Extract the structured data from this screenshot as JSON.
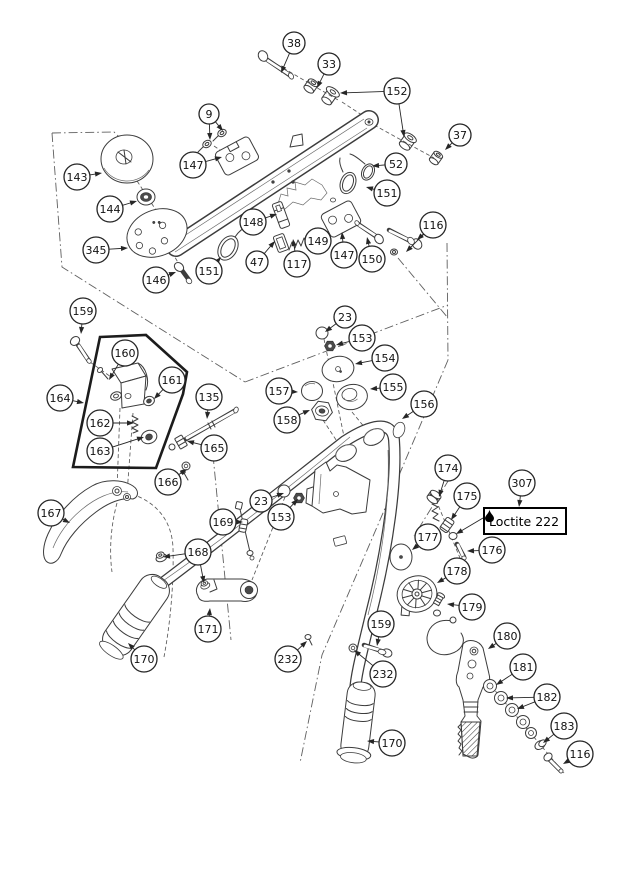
{
  "canvas": {
    "width": 620,
    "height": 876,
    "background": "#ffffff",
    "ink": "#3c3c3c",
    "callout_ink": "#262626"
  },
  "diagram": {
    "type": "exploded-parts-diagram",
    "label_box": {
      "text": "Loctite 222",
      "icon": "droplet-icon",
      "x": 483,
      "y": 507,
      "w": 80,
      "h": 22,
      "target": [
        456,
        534
      ]
    },
    "callouts": [
      {
        "id": "38",
        "label": "38",
        "x": 294,
        "y": 43,
        "r": 11,
        "targets": [
          [
            281,
            73
          ]
        ]
      },
      {
        "id": "33",
        "label": "33",
        "x": 329,
        "y": 64,
        "r": 11,
        "targets": [
          [
            317,
            88
          ]
        ]
      },
      {
        "id": "152",
        "label": "152",
        "x": 397,
        "y": 91,
        "r": 13,
        "targets": [
          [
            340,
            93
          ],
          [
            404,
            137
          ]
        ]
      },
      {
        "id": "9",
        "label": "9",
        "x": 209,
        "y": 114,
        "r": 10,
        "targets": [
          [
            210,
            140
          ],
          [
            223,
            131
          ]
        ]
      },
      {
        "id": "37",
        "label": "37",
        "x": 460,
        "y": 135,
        "r": 11,
        "targets": [
          [
            445,
            150
          ]
        ]
      },
      {
        "id": "147a",
        "label": "147",
        "x": 193,
        "y": 165,
        "r": 13,
        "targets": [
          [
            222,
            157
          ]
        ]
      },
      {
        "id": "52",
        "label": "52",
        "x": 396,
        "y": 164,
        "r": 11,
        "targets": [
          [
            372,
            166
          ]
        ]
      },
      {
        "id": "151a",
        "label": "151",
        "x": 387,
        "y": 193,
        "r": 13,
        "targets": [
          [
            366,
            187
          ]
        ]
      },
      {
        "id": "143",
        "label": "143",
        "x": 77,
        "y": 177,
        "r": 13,
        "targets": [
          [
            102,
            173
          ]
        ]
      },
      {
        "id": "144",
        "label": "144",
        "x": 110,
        "y": 209,
        "r": 13,
        "targets": [
          [
            137,
            201
          ]
        ]
      },
      {
        "id": "345",
        "label": "345",
        "x": 96,
        "y": 250,
        "r": 13,
        "targets": [
          [
            128,
            248
          ]
        ]
      },
      {
        "id": "146",
        "label": "146",
        "x": 156,
        "y": 280,
        "r": 13,
        "targets": [
          [
            176,
            272
          ]
        ]
      },
      {
        "id": "151b",
        "label": "151",
        "x": 209,
        "y": 271,
        "r": 13,
        "targets": [
          [
            221,
            257
          ]
        ]
      },
      {
        "id": "148",
        "label": "148",
        "x": 253,
        "y": 222,
        "r": 13,
        "targets": [
          [
            277,
            214
          ]
        ]
      },
      {
        "id": "47",
        "label": "47",
        "x": 257,
        "y": 262,
        "r": 11,
        "targets": [
          [
            275,
            241
          ]
        ]
      },
      {
        "id": "117",
        "label": "117",
        "x": 297,
        "y": 264,
        "r": 13,
        "targets": [
          [
            293,
            239
          ]
        ]
      },
      {
        "id": "149",
        "label": "149",
        "x": 318,
        "y": 241,
        "r": 13,
        "targets": [
          [
            316,
            228
          ]
        ]
      },
      {
        "id": "147b",
        "label": "147",
        "x": 344,
        "y": 255,
        "r": 13,
        "targets": [
          [
            342,
            232
          ]
        ]
      },
      {
        "id": "150",
        "label": "150",
        "x": 372,
        "y": 259,
        "r": 13,
        "targets": [
          [
            367,
            237
          ]
        ]
      },
      {
        "id": "116a",
        "label": "116",
        "x": 433,
        "y": 225,
        "r": 13,
        "targets": [
          [
            417,
            240
          ],
          [
            406,
            252
          ]
        ]
      },
      {
        "id": "159a",
        "label": "159",
        "x": 83,
        "y": 311,
        "r": 13,
        "targets": [
          [
            81,
            334
          ]
        ]
      },
      {
        "id": "23a",
        "label": "23",
        "x": 345,
        "y": 317,
        "r": 11,
        "targets": [
          [
            325,
            332
          ]
        ]
      },
      {
        "id": "153a",
        "label": "153",
        "x": 362,
        "y": 338,
        "r": 13,
        "targets": [
          [
            336,
            345
          ]
        ]
      },
      {
        "id": "154",
        "label": "154",
        "x": 385,
        "y": 358,
        "r": 13,
        "targets": [
          [
            355,
            364
          ]
        ]
      },
      {
        "id": "160",
        "label": "160",
        "x": 125,
        "y": 353,
        "r": 13,
        "targets": [
          [
            109,
            380
          ]
        ]
      },
      {
        "id": "161",
        "label": "161",
        "x": 172,
        "y": 380,
        "r": 13,
        "targets": [
          [
            154,
            399
          ]
        ]
      },
      {
        "id": "164",
        "label": "164",
        "x": 60,
        "y": 398,
        "r": 13,
        "targets": [
          [
            84,
            403
          ]
        ]
      },
      {
        "id": "135",
        "label": "135",
        "x": 209,
        "y": 397,
        "r": 13,
        "targets": [
          [
            207,
            419
          ]
        ]
      },
      {
        "id": "157",
        "label": "157",
        "x": 279,
        "y": 391,
        "r": 13,
        "targets": [
          [
            298,
            392
          ]
        ]
      },
      {
        "id": "155",
        "label": "155",
        "x": 393,
        "y": 387,
        "r": 13,
        "targets": [
          [
            370,
            389
          ]
        ]
      },
      {
        "id": "158",
        "label": "158",
        "x": 287,
        "y": 420,
        "r": 13,
        "targets": [
          [
            310,
            410
          ]
        ]
      },
      {
        "id": "156",
        "label": "156",
        "x": 424,
        "y": 404,
        "r": 13,
        "targets": [
          [
            402,
            419
          ]
        ]
      },
      {
        "id": "162",
        "label": "162",
        "x": 100,
        "y": 423,
        "r": 13,
        "targets": [
          [
            134,
            423
          ]
        ]
      },
      {
        "id": "163",
        "label": "163",
        "x": 100,
        "y": 451,
        "r": 13,
        "targets": [
          [
            144,
            437
          ]
        ]
      },
      {
        "id": "165",
        "label": "165",
        "x": 214,
        "y": 448,
        "r": 13,
        "targets": [
          [
            187,
            441
          ]
        ]
      },
      {
        "id": "166",
        "label": "166",
        "x": 168,
        "y": 482,
        "r": 13,
        "targets": [
          [
            187,
            469
          ]
        ]
      },
      {
        "id": "174",
        "label": "174",
        "x": 448,
        "y": 468,
        "r": 13,
        "targets": [
          [
            439,
            497
          ]
        ]
      },
      {
        "id": "175",
        "label": "175",
        "x": 467,
        "y": 496,
        "r": 13,
        "targets": [
          [
            451,
            520
          ]
        ]
      },
      {
        "id": "307",
        "label": "307",
        "x": 522,
        "y": 483,
        "r": 13,
        "targets": [
          [
            519,
            507
          ]
        ]
      },
      {
        "id": "177",
        "label": "177",
        "x": 428,
        "y": 537,
        "r": 13,
        "targets": [
          [
            412,
            550
          ]
        ]
      },
      {
        "id": "176",
        "label": "176",
        "x": 492,
        "y": 550,
        "r": 13,
        "targets": [
          [
            467,
            551
          ]
        ]
      },
      {
        "id": "178",
        "label": "178",
        "x": 457,
        "y": 571,
        "r": 13,
        "targets": [
          [
            437,
            583
          ]
        ]
      },
      {
        "id": "179",
        "label": "179",
        "x": 472,
        "y": 607,
        "r": 13,
        "targets": [
          [
            447,
            604
          ]
        ]
      },
      {
        "id": "167",
        "label": "167",
        "x": 51,
        "y": 513,
        "r": 13,
        "targets": [
          [
            70,
            523
          ]
        ]
      },
      {
        "id": "169",
        "label": "169",
        "x": 223,
        "y": 522,
        "r": 13,
        "targets": [
          [
            243,
            522
          ]
        ]
      },
      {
        "id": "23b",
        "label": "23",
        "x": 261,
        "y": 501,
        "r": 11,
        "targets": [
          [
            284,
            493
          ]
        ]
      },
      {
        "id": "153b",
        "label": "153",
        "x": 281,
        "y": 517,
        "r": 13,
        "targets": [
          [
            298,
            499
          ]
        ]
      },
      {
        "id": "168",
        "label": "168",
        "x": 198,
        "y": 552,
        "r": 13,
        "targets": [
          [
            163,
            557
          ],
          [
            204,
            583
          ]
        ]
      },
      {
        "id": "171",
        "label": "171",
        "x": 208,
        "y": 629,
        "r": 13,
        "targets": [
          [
            210,
            608
          ]
        ]
      },
      {
        "id": "170a",
        "label": "170",
        "x": 144,
        "y": 659,
        "r": 13,
        "targets": [
          [
            128,
            643
          ]
        ]
      },
      {
        "id": "232a",
        "label": "232",
        "x": 288,
        "y": 659,
        "r": 13,
        "targets": [
          [
            307,
            641
          ]
        ]
      },
      {
        "id": "159b",
        "label": "159",
        "x": 381,
        "y": 624,
        "r": 13,
        "targets": [
          [
            377,
            646
          ]
        ]
      },
      {
        "id": "232b",
        "label": "232",
        "x": 383,
        "y": 674,
        "r": 13,
        "targets": [
          [
            354,
            650
          ]
        ]
      },
      {
        "id": "170b",
        "label": "170",
        "x": 392,
        "y": 743,
        "r": 13,
        "targets": [
          [
            367,
            741
          ]
        ]
      },
      {
        "id": "180",
        "label": "180",
        "x": 507,
        "y": 636,
        "r": 13,
        "targets": [
          [
            488,
            649
          ]
        ]
      },
      {
        "id": "181",
        "label": "181",
        "x": 523,
        "y": 667,
        "r": 13,
        "targets": [
          [
            496,
            685
          ]
        ]
      },
      {
        "id": "182",
        "label": "182",
        "x": 547,
        "y": 697,
        "r": 13,
        "targets": [
          [
            506,
            698
          ],
          [
            517,
            709
          ]
        ]
      },
      {
        "id": "183",
        "label": "183",
        "x": 564,
        "y": 726,
        "r": 13,
        "targets": [
          [
            543,
            743
          ]
        ]
      },
      {
        "id": "116b",
        "label": "116",
        "x": 580,
        "y": 754,
        "r": 13,
        "targets": [
          [
            563,
            764
          ]
        ]
      }
    ]
  }
}
